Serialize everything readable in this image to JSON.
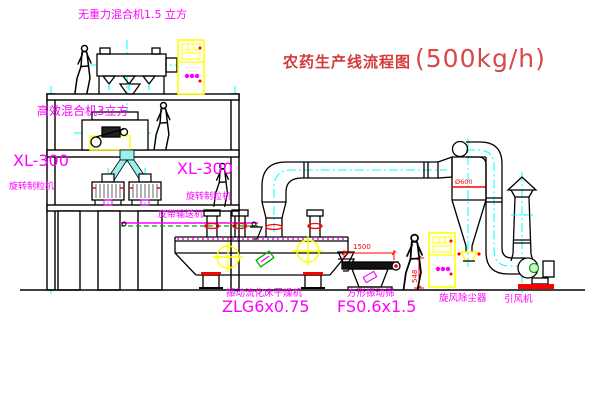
{
  "title": {
    "cn": "农药生产线流程图",
    "capacity": "(500kg/h)"
  },
  "labels": {
    "gravity_mixer": "无重力混合机1.5 立方",
    "high_efficiency_mixer": "高效混合机3立方",
    "granulator_left_model": "XL-300",
    "granulator_left_name": "旋转制粒机",
    "granulator_right_model": "XL-300",
    "granulator_right_name": "旋转制粒机",
    "belt_conveyor": "皮带输送机",
    "dryer_name": "振动流化床干燥机",
    "dryer_model": "ZLG6x0.75",
    "sieve_name": "方形振动筛",
    "sieve_model": "FS0.6x1.5",
    "cyclone": "旋风除尘器",
    "fan": "引风机"
  },
  "dimensions": {
    "sieve_length": "1500",
    "sieve_outlet_height": "548",
    "cyclone_diameter": "Ø600"
  },
  "colors": {
    "label_magenta": "#ff00ff",
    "title_red": "#d43a3a",
    "dimension_red": "#ff0000",
    "centerline_cyan": "#00ffff",
    "cabinet_yellow": "#ffff00",
    "line_black": "#000000"
  }
}
